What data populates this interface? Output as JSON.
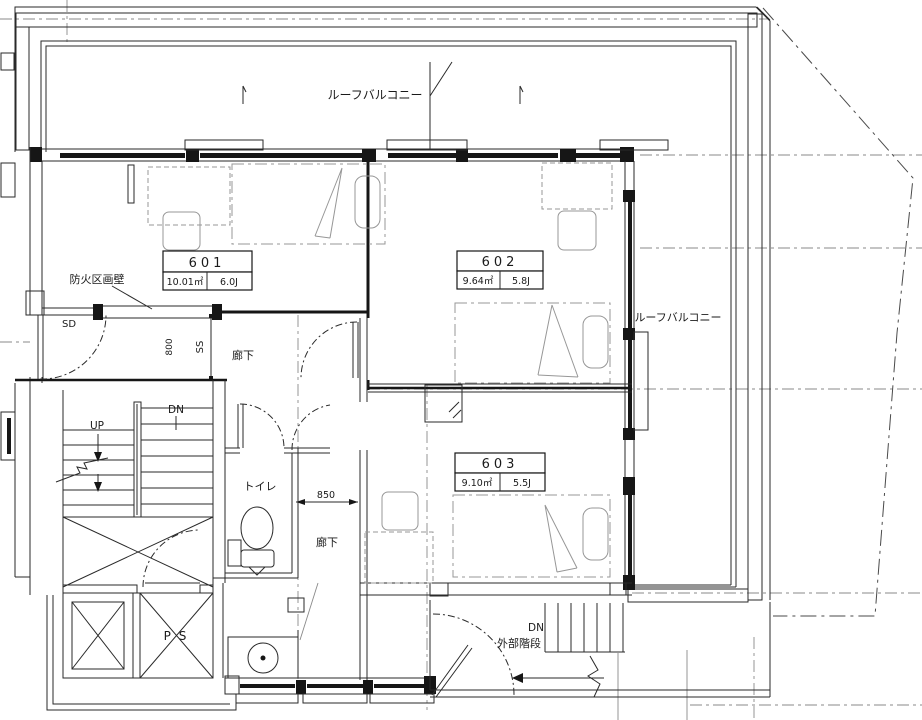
{
  "plan": {
    "title": "6F floor plan",
    "labels": {
      "roof_balcony_top": "ルーフバルコニー",
      "roof_balcony_right": "ルーフバルコニー",
      "fire_wall": "防火区画壁",
      "sd": "SD",
      "ss": "SS",
      "dim_800": "800",
      "dim_850": "850",
      "corridor_upper": "廊下",
      "corridor_lower": "廊下",
      "up": "UP",
      "dn_stairs": "DN",
      "dn_external": "DN",
      "toilet": "トイレ",
      "pipe_space": "P S",
      "external_stairs": "外部階段"
    },
    "rooms": [
      {
        "number": "601",
        "area": "10.01㎡",
        "tatami": "6.0J"
      },
      {
        "number": "602",
        "area": "9.64㎡",
        "tatami": "5.8J"
      },
      {
        "number": "603",
        "area": "9.10㎡",
        "tatami": "5.5J"
      }
    ],
    "colors": {
      "ink": "#1a1a1a",
      "grid": "#8a8a8a",
      "furniture": "#979797",
      "background": "#ffffff"
    }
  }
}
